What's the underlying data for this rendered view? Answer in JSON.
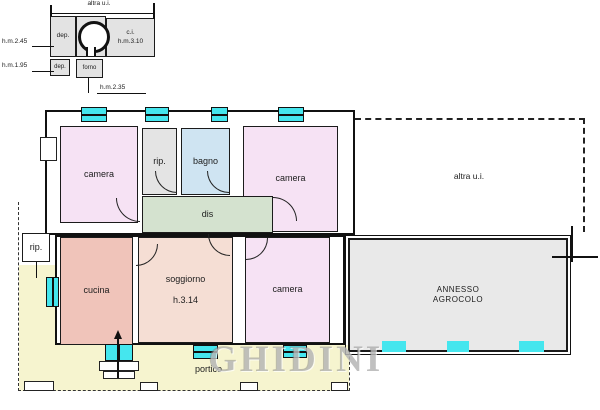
{
  "watermark": "GHIDINI",
  "inset_plan": {
    "title": "altra u.i.",
    "dep_top": "dep.",
    "dep_bottom": "dep.",
    "forno": "forno",
    "ci_line1": "c.i.",
    "ci_line2": "h.m.3.10",
    "dim_left_top": "h.m.2.45",
    "dim_left_bottom": "h.m.1.95",
    "dim_bottom": "h.m.2.35"
  },
  "floor_plan": {
    "camera_nw": "camera",
    "rip_top": "rip.",
    "bagno": "bagno",
    "camera_n": "camera",
    "altra_ui": "altra u.i.",
    "dis": "dis",
    "rip_west": "rip.",
    "cucina": "cucina",
    "soggiorno": "soggiorno",
    "soggiorno_height": "h.3.14",
    "camera_s": "camera",
    "annesso_line1": "ANNESSO",
    "annesso_line2": "AGROCOLO",
    "portico": "portico"
  },
  "colors": {
    "window": "#45e6ee",
    "camera": "#f6e2f4",
    "bagno": "#cfe4f2",
    "rip": "#e4e4e4",
    "dis": "#d4e2cf",
    "cucina": "#f0c4ba",
    "soggiorno": "#f5ded4",
    "annesso": "#e9e9e9",
    "portico": "#f6f4cf",
    "inset_room": "#e3e3e3"
  }
}
